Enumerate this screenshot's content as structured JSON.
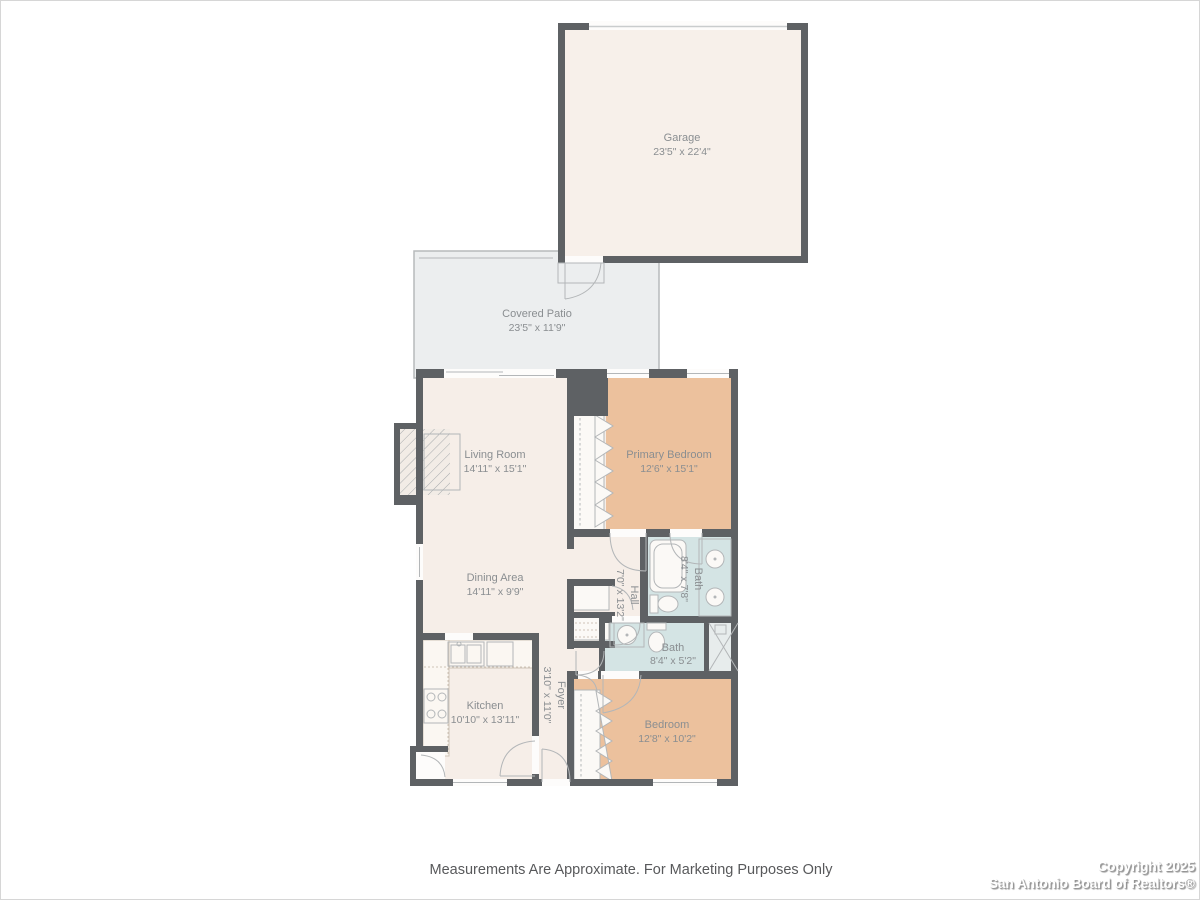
{
  "page": {
    "disclaimer": "Measurements Are Approximate. For Marketing Purposes Only",
    "copyright_line1": "Copyright 2025",
    "copyright_line2": "San Antonio Board of Realtors®"
  },
  "colors": {
    "wall": "#5e6164",
    "floor-cream": "#f6eee8",
    "floor-tan": "#ecc19d",
    "floor-bath": "#d4e4e4",
    "floor-patio": "#eceeef",
    "floor-garage": "#f7f0ea",
    "fixture-line": "#b3b6b8",
    "label-text": "#8a8e91"
  },
  "rooms": {
    "garage": {
      "name": "Garage",
      "dims": "23'5\" x 22'4\""
    },
    "covered_patio": {
      "name": "Covered Patio",
      "dims": "23'5\" x 11'9\""
    },
    "living_room": {
      "name": "Living Room",
      "dims": "14'11\" x 15'1\""
    },
    "primary_bedroom": {
      "name": "Primary Bedroom",
      "dims": "12'6\" x 15'1\""
    },
    "dining_area": {
      "name": "Dining Area",
      "dims": "14'11\" x 9'9\""
    },
    "primary_bath": {
      "name": "Bath",
      "dims": "8'4\" x 7'8\""
    },
    "hall": {
      "name": "Hall",
      "dims": "7'0\" x 13'2\""
    },
    "bath_2": {
      "name": "Bath",
      "dims": "8'4\" x 5'2\""
    },
    "kitchen": {
      "name": "Kitchen",
      "dims": "10'10\" x 13'11\""
    },
    "foyer": {
      "name": "Foyer",
      "dims": "3'10\" x 11'0\""
    },
    "bedroom": {
      "name": "Bedroom",
      "dims": "12'8\" x 10'2\""
    }
  }
}
